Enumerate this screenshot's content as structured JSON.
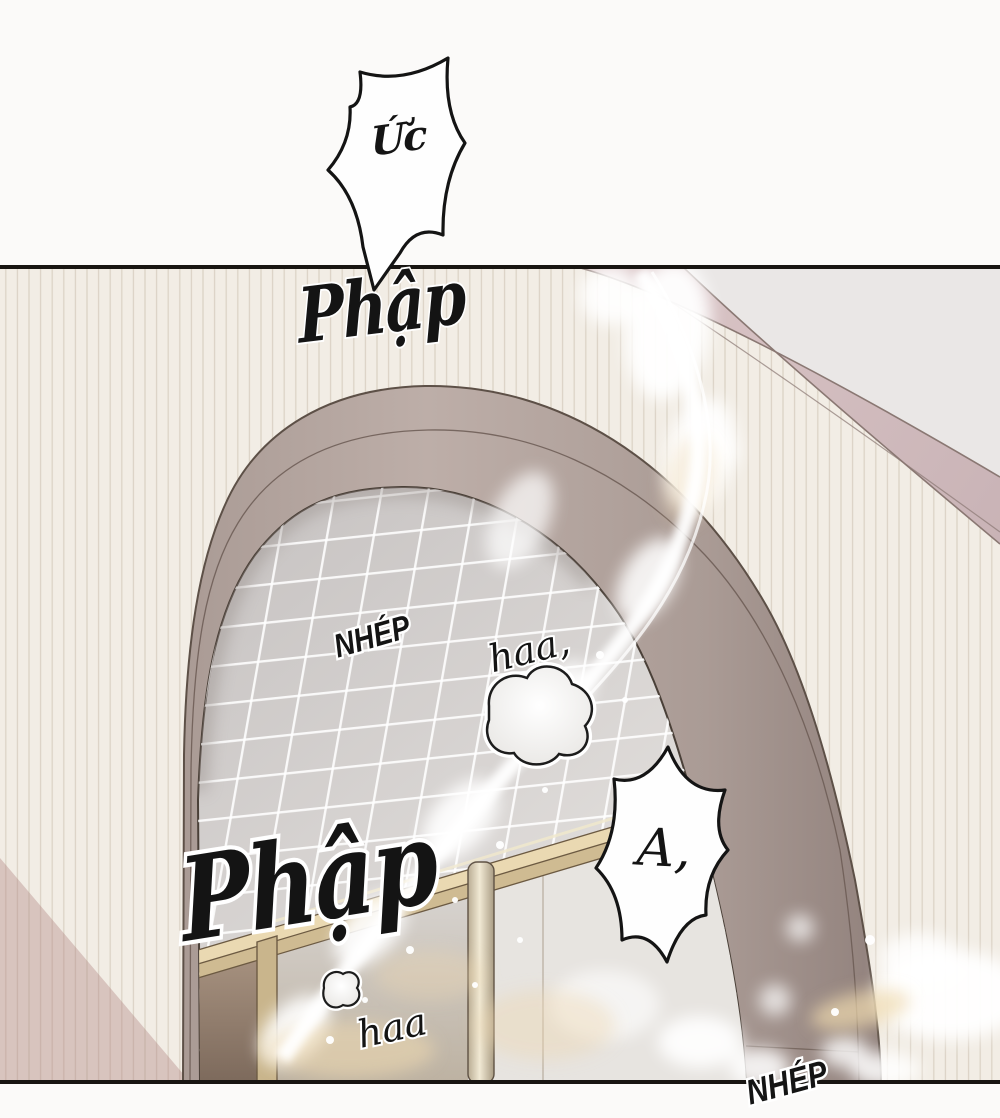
{
  "page": {
    "kind": "manhwa-comic-panel",
    "language": "vi"
  },
  "sfx": {
    "uc": "Ức",
    "phap_top": "Phập",
    "nhep_top": "NHÉP",
    "haa_top": "haa,",
    "phap_big": "Phập",
    "a_bubble": "A,",
    "haa_bottom": "haa",
    "nhep_bottom": "NHÉP"
  },
  "palette": {
    "paper": "#fbfaf9",
    "wall": "#f2ede5",
    "stripe": "#d7cec1",
    "shadow": "rgba(173,129,125,0.38)",
    "ceiling": "#eae7e6",
    "beam_hi": "#dcc7c8",
    "beam_lo": "#c9b3b6",
    "beam_edge": "#8a7873",
    "band_hi": "#bdaea8",
    "band_mid": "#aa9b95",
    "band_lo": "#92827d",
    "band_edge": "#5d5047",
    "open_hi": "#c7c3c2",
    "open_lo": "#e9e6e3",
    "grid_line": "rgba(255,255,255,0.88)",
    "frame_hi": "#ead9b2",
    "frame_lo": "#cfbb92",
    "frame_edge": "#6c5a42",
    "interior_hi": "#a5907e",
    "interior_lo": "#7d6a5c",
    "glass_mid": "#d6d2ce",
    "glass_mid_lo": "#bdb2a2",
    "glass_light": "#e7e4e0",
    "post": "#c9b58c",
    "warm": "#eed8ae",
    "flare": "#ffffff",
    "ink": "#141414",
    "bubble_fill": "#fefefe",
    "border": "#181512"
  }
}
